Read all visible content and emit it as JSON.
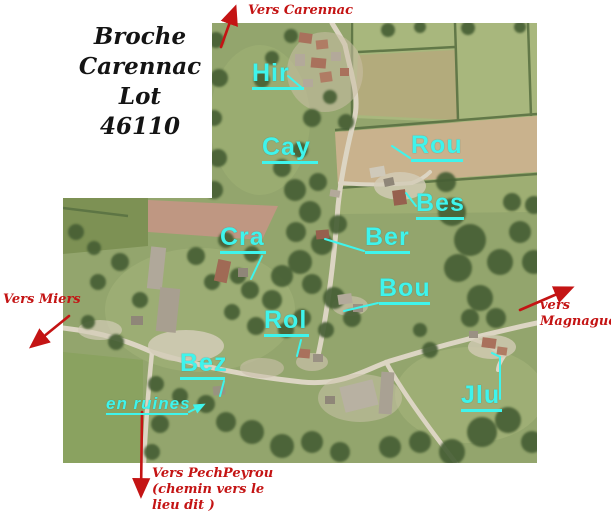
{
  "title_block": {
    "lines": [
      "Broche",
      "Carennac",
      "Lot",
      "46110"
    ]
  },
  "place_labels": [
    {
      "id": "hir",
      "text": "Hir"
    },
    {
      "id": "cay",
      "text": "Cay"
    },
    {
      "id": "rou",
      "text": "Rou"
    },
    {
      "id": "bes",
      "text": "Bes"
    },
    {
      "id": "cra",
      "text": "Cra"
    },
    {
      "id": "ber",
      "text": "Ber"
    },
    {
      "id": "bou",
      "text": "Bou"
    },
    {
      "id": "rol",
      "text": "Rol"
    },
    {
      "id": "bez",
      "text": "Bez"
    },
    {
      "id": "jlu",
      "text": "Jlu"
    }
  ],
  "annotations": {
    "ruins": "en ruines"
  },
  "direction_arrows": {
    "north": {
      "label": "Vers Carennac",
      "direction": "up"
    },
    "west": {
      "label": "Vers Miers",
      "direction": "down-left"
    },
    "east": {
      "label_lines": [
        "vers",
        "Magnagues"
      ],
      "direction": "up-right"
    },
    "south": {
      "label_lines": [
        "Vers PechPeyrou",
        "(chemin vers le",
        "lieu dit )"
      ],
      "direction": "down"
    }
  },
  "colors": {
    "place_label_cyan": "#3ff4ec",
    "arrow_red": "#c41414",
    "title_text": "#141414",
    "background": "#ffffff"
  }
}
